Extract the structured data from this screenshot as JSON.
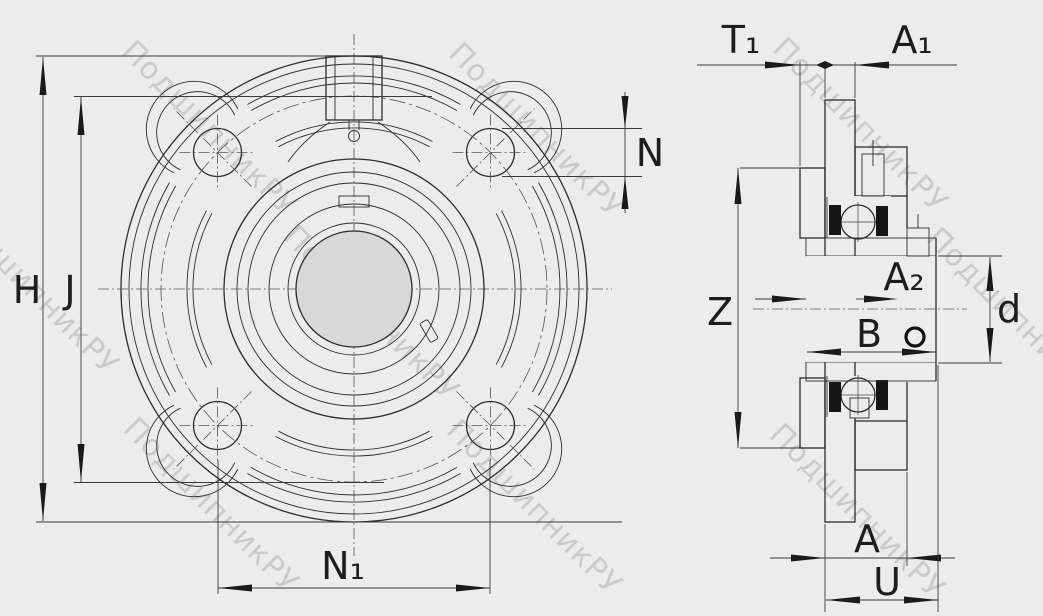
{
  "drawing": {
    "watermark_text": "ПодшипникРУ",
    "dimension_labels": {
      "h": "H",
      "j": "J",
      "n": "N",
      "n1": "N₁",
      "t1": "T₁",
      "a1": "A₁",
      "a2": "A₂",
      "z": "Z",
      "b": "B",
      "d": "d",
      "a": "A",
      "u": "U"
    },
    "colors": {
      "background": "#ececec",
      "line": "#2d2d2d",
      "bore_fill": "#d8d8d8",
      "watermark": "#b6b6b6"
    }
  }
}
